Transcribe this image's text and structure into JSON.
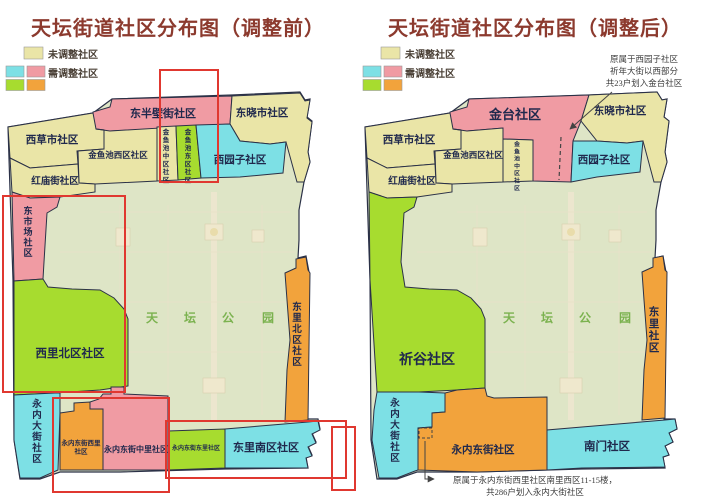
{
  "colors": {
    "yellow": "#eae5a7",
    "pink": "#f09ba3",
    "cyan": "#7de0e5",
    "green": "#a7dc2f",
    "orange": "#f2a33c",
    "park": "#dee5c6",
    "stroke": "#2b3147",
    "red_box": "#e03830",
    "title": "#8c3a2e",
    "label": "#20294d",
    "park_text": "#7bb24f",
    "annotation": "#3c3c3c",
    "legend_text": "#4a4036"
  },
  "legend": {
    "rows": [
      {
        "y": 47,
        "swatches": [
          {
            "x": 24,
            "w": 19,
            "h": 12,
            "color": "yellow"
          }
        ],
        "label": {
          "text": "未调整社区",
          "x": 48,
          "y": 58
        }
      },
      {
        "y": 66,
        "swatches": [
          {
            "x": 6,
            "w": 18,
            "h": 11,
            "color": "cyan"
          },
          {
            "x": 27,
            "w": 18,
            "h": 11,
            "color": "pink"
          }
        ],
        "label": {
          "text": "需调整社区",
          "x": 48,
          "y": 77
        }
      },
      {
        "y": 79.5,
        "swatches": [
          {
            "x": 6,
            "w": 18,
            "h": 11,
            "color": "green"
          },
          {
            "x": 27,
            "w": 18,
            "h": 11,
            "color": "orange"
          }
        ],
        "label": null
      }
    ]
  },
  "left_panel": {
    "title": "天坛街道社区分布图（调整前）",
    "outline": "8,127 93,113 112,99 232,95 300,92 305,100 310,99 307,117 312,121 308,152 310,162 304,182 299,210 299,240 298,258 306,256 309,272 307,419 318,419 320,429 312,433 316,442 308,446 312,455 306,457 308,468 225,469 190,470 120,472 60,472 40,479 20,479 14,440 13,280 10,190",
    "park_label": {
      "text": "天坛公园",
      "chars_x": [
        152,
        190,
        228,
        268
      ],
      "y": 322,
      "size": 12
    },
    "regions": [
      {
        "id": "donghalfbi",
        "name": "东半壁街社区",
        "color": "pink",
        "points": "88,132 93,112 110,107 112,99 232,96 230,124 160,129 110,131",
        "label": {
          "x": 163,
          "y": 117,
          "size": 11
        }
      },
      {
        "id": "dongxiaoshi",
        "name": "东晓市社区",
        "color": "yellow",
        "points": "232,96 300,93 305,101 310,100 307,118 312,122 308,152 310,162 304,182 297,182 286,142 270,144 240,141 230,124",
        "label": {
          "x": 262,
          "y": 116,
          "size": 10.5
        }
      },
      {
        "id": "xicaoshi",
        "name": "西草市社区",
        "color": "yellow",
        "points": "8,127 93,113 96,129 104,130 104,149 77,151 78,164 30,168 10,158",
        "label": {
          "x": 52,
          "y": 143,
          "size": 10.5
        }
      },
      {
        "id": "jinyuchi_xi",
        "name": "金鱼池西区社区",
        "color": "yellow",
        "points": "96,129 110,131 160,128 157,133 157,181 95,184 79,183 78,151 104,149 104,130",
        "label": {
          "x": 118,
          "y": 158,
          "size": 8.5
        }
      },
      {
        "id": "hongmiao",
        "name": "红庙街社区",
        "color": "yellow",
        "points": "10,158 30,168 78,164 79,183 95,184 95,192 60,197 30,198 12,192",
        "label": {
          "x": 55,
          "y": 184,
          "size": 9.5
        }
      },
      {
        "id": "jinyuchi_zhong",
        "name": "金鱼池中区社区",
        "color": "yellow",
        "points": "157,127 176,126 178,180 157,181",
        "label": {
          "x": 166,
          "y": 134,
          "size": 6.5,
          "vertical": true
        }
      },
      {
        "id": "jinyuchi_dong",
        "name": "金鱼池东区社区",
        "color": "green",
        "points": "176,126 196,125 201,178 178,180",
        "label": {
          "x": 188,
          "y": 134,
          "size": 6.5,
          "vertical": true
        }
      },
      {
        "id": "xiyuanzi",
        "name": "西园子社区",
        "color": "cyan",
        "points": "196,125 230,124 240,141 270,144 286,142 283,173 240,177 201,178",
        "label": {
          "x": 240,
          "y": 163,
          "size": 10.5
        }
      },
      {
        "id": "dongshichang",
        "name": "东市场社区",
        "color": "pink",
        "points": "12,192 30,198 60,197 57,207 47,213 44,262 43,279 14,281",
        "label": {
          "x": 28,
          "y": 214,
          "size": 9,
          "vertical": true
        }
      },
      {
        "id": "xilibei",
        "name": "西里北区社区",
        "color": "green",
        "points": "14,281 43,279 48,287 72,289 100,290 114,298 124,309 128,319 128,386 100,390 55,393 14,395",
        "label": {
          "x": 70,
          "y": 357,
          "size": 11.5
        }
      },
      {
        "id": "yongnei_dajie",
        "name": "永内大街社区",
        "color": "cyan",
        "points": "14,395 55,393 60,393 60,413 58,470 40,478 20,478 14,440",
        "label": {
          "x": 37,
          "y": 407,
          "size": 9.5,
          "vertical": true
        }
      },
      {
        "id": "yongnei_xili",
        "name": "永内东街西里社区",
        "color": "orange",
        "points": "60,413 74,411 74,403 90,402 90,409 103,409 103,470 60,470",
        "label": {
          "x": 81,
          "y": 445,
          "size": 6.5,
          "lines": [
            "永内东街西里",
            "社区"
          ]
        }
      },
      {
        "id": "yongnei_zhongli",
        "name": "永内东街中里社区",
        "color": "pink",
        "points": "90,402 99,399 103,394 111,394 111,387 124,387 124,394 168,396 168,470 103,470 103,409 90,409",
        "label": {
          "x": 136,
          "y": 452,
          "size": 8
        }
      },
      {
        "id": "yongnei_dongli",
        "name": "永内东街东里社区",
        "color": "green",
        "points": "168,431 225,429 225,468 168,470",
        "label": {
          "x": 196,
          "y": 450,
          "size": 6
        }
      },
      {
        "id": "donglinan",
        "name": "东里南区社区",
        "color": "cyan",
        "points": "225,429 308,422 318,421 320,430 312,434 316,443 308,447 312,456 306,458 308,468 225,468",
        "label": {
          "x": 266,
          "y": 451,
          "size": 11
        }
      },
      {
        "id": "donglibei",
        "name": "东里北区社区",
        "color": "orange",
        "points": "285,273 296,268 296,259 306,257 308,270 310,273 308,420 285,422 287,370 290,340 287,300",
        "label": {
          "x": 297,
          "y": 310,
          "size": 9.5,
          "vertical": true
        }
      }
    ],
    "highlight_boxes": [
      {
        "x": 160,
        "y": 70,
        "w": 58,
        "h": 112
      },
      {
        "x": 3,
        "y": 196,
        "w": 122,
        "h": 196
      },
      {
        "x": 53,
        "y": 398,
        "w": 116,
        "h": 94
      },
      {
        "x": 166,
        "y": 421,
        "w": 180,
        "h": 57
      },
      {
        "x": 332,
        "y": 427,
        "w": 23,
        "h": 63
      }
    ]
  },
  "right_panel": {
    "title": "天坛街道社区分布图（调整后）",
    "outline": "8,127 93,113 112,99 232,95 300,92 305,100 310,99 307,117 312,121 308,152 310,162 304,182 299,210 299,240 298,258 306,256 309,272 307,419 318,419 320,429 312,433 316,442 308,446 312,455 306,457 308,468 225,469 190,470 120,472 60,472 40,479 20,479 14,440 13,280 10,190",
    "park_label": {
      "text": "天坛公园",
      "chars_x": [
        152,
        190,
        228,
        268
      ],
      "y": 322,
      "size": 12
    },
    "regions": [
      {
        "id": "jintai",
        "name": "金台社区",
        "color": "pink",
        "points": "88,131 93,112 110,107 112,99 232,95 224,121 216,141 214,182 176,181 176,140 146,139 146,128 110,131",
        "label": {
          "x": 158,
          "y": 119,
          "size": 13
        }
      },
      {
        "id": "dongxiaoshi",
        "name": "东晓市社区",
        "color": "yellow",
        "points": "232,95 300,92 305,100 310,99 307,117 312,121 308,152 310,162 304,182 297,182 286,141 270,143 240,141 224,121",
        "label": {
          "x": 263,
          "y": 114,
          "size": 10.5
        }
      },
      {
        "id": "xiyuanzi",
        "name": "西园子社区",
        "color": "cyan",
        "points": "216,141 240,141 270,143 286,141 283,172 240,177 214,182",
        "label": {
          "x": 247,
          "y": 163,
          "size": 10.5
        }
      },
      {
        "id": "xicaoshi",
        "name": "西草市社区",
        "color": "yellow",
        "points": "8,127 93,113 96,129 104,130 104,149 77,151 78,164 30,168 10,158",
        "label": {
          "x": 52,
          "y": 143,
          "size": 10.5
        }
      },
      {
        "id": "jinyuchi_xi",
        "name": "金鱼池西区社区",
        "color": "yellow",
        "points": "96,129 110,131 146,128 146,182 95,184 79,183 78,151 104,149 104,130",
        "label": {
          "x": 116,
          "y": 158,
          "size": 8.5
        }
      },
      {
        "id": "hongmiao",
        "name": "红庙街社区",
        "color": "yellow",
        "points": "10,158 30,168 78,164 79,183 95,184 95,192 60,197 30,198 12,192",
        "label": {
          "x": 55,
          "y": 184,
          "size": 9.5
        }
      },
      {
        "id": "jinyuchi_zhong",
        "name": "金鱼池中区社区",
        "color": "yellow",
        "points": "146,139 176,140 176,181 146,182",
        "label": {
          "x": 160,
          "y": 146,
          "size": 5.8,
          "vertical": true
        }
      },
      {
        "id": "qigu",
        "name": "祈谷社区",
        "color": "green",
        "points": "12,192 30,198 60,197 57,207 47,213 44,262 48,287 72,289 100,290 114,298 124,309 128,319 128,388 100,390 62,392 20,392 13,280",
        "label": {
          "x": 70,
          "y": 364,
          "size": 14
        }
      },
      {
        "id": "yongnei_dajie",
        "name": "永内大街社区",
        "color": "cyan",
        "points": "20,392 62,392 88,393 88,412 75,413 75,427 61,428 61,470 58,471 40,478 22,478 15,440 17,410",
        "label": {
          "x": 38,
          "y": 406,
          "size": 9.5,
          "vertical": true
        }
      },
      {
        "id": "yongnei_dongjie",
        "name": "永内东街社区",
        "color": "orange",
        "points": "61,470 61,428 75,427 75,413 88,412 88,393 100,390 128,388 130,396 137,398 190,397 190,470 120,472",
        "label": {
          "x": 126,
          "y": 453,
          "size": 10.5
        }
      },
      {
        "id": "nanmen",
        "name": "南门社区",
        "color": "cyan",
        "points": "190,470 190,430 225,427 308,420 318,419 320,429 312,433 316,442 308,446 312,455 306,457 308,467 225,468",
        "label": {
          "x": 250,
          "y": 450,
          "size": 11.5
        }
      },
      {
        "id": "dongli",
        "name": "东里社区",
        "color": "orange",
        "points": "285,272 296,267 296,258 306,256 308,270 310,272 308,418 285,420 287,370 290,340 287,300",
        "label": {
          "x": 297,
          "y": 315,
          "size": 10.5,
          "vertical": true
        }
      }
    ],
    "annotations": {
      "top": {
        "x": 287,
        "y": 62,
        "line_height": 12,
        "lines": [
          "原属于西园子社区",
          "祈年大街以西部分",
          "共23户划入金台社区"
        ]
      },
      "bottom": {
        "x": 178,
        "y": 483,
        "line_height": 12,
        "lines": [
          "原属于永内东街西里社区南里西区11-15楼，",
          "共286户划入永内大街社区"
        ]
      },
      "top_arrow": {
        "x1": 255,
        "y1": 92,
        "x2": 213,
        "y2": 129
      },
      "bottom_arrow": "68,441 68,479 77,479",
      "dashed_line": {
        "x1": 204,
        "y1": 137,
        "x2": 202,
        "y2": 180
      },
      "dashed_rect": {
        "x": 62,
        "y": 428,
        "w": 13,
        "h": 10
      }
    }
  }
}
